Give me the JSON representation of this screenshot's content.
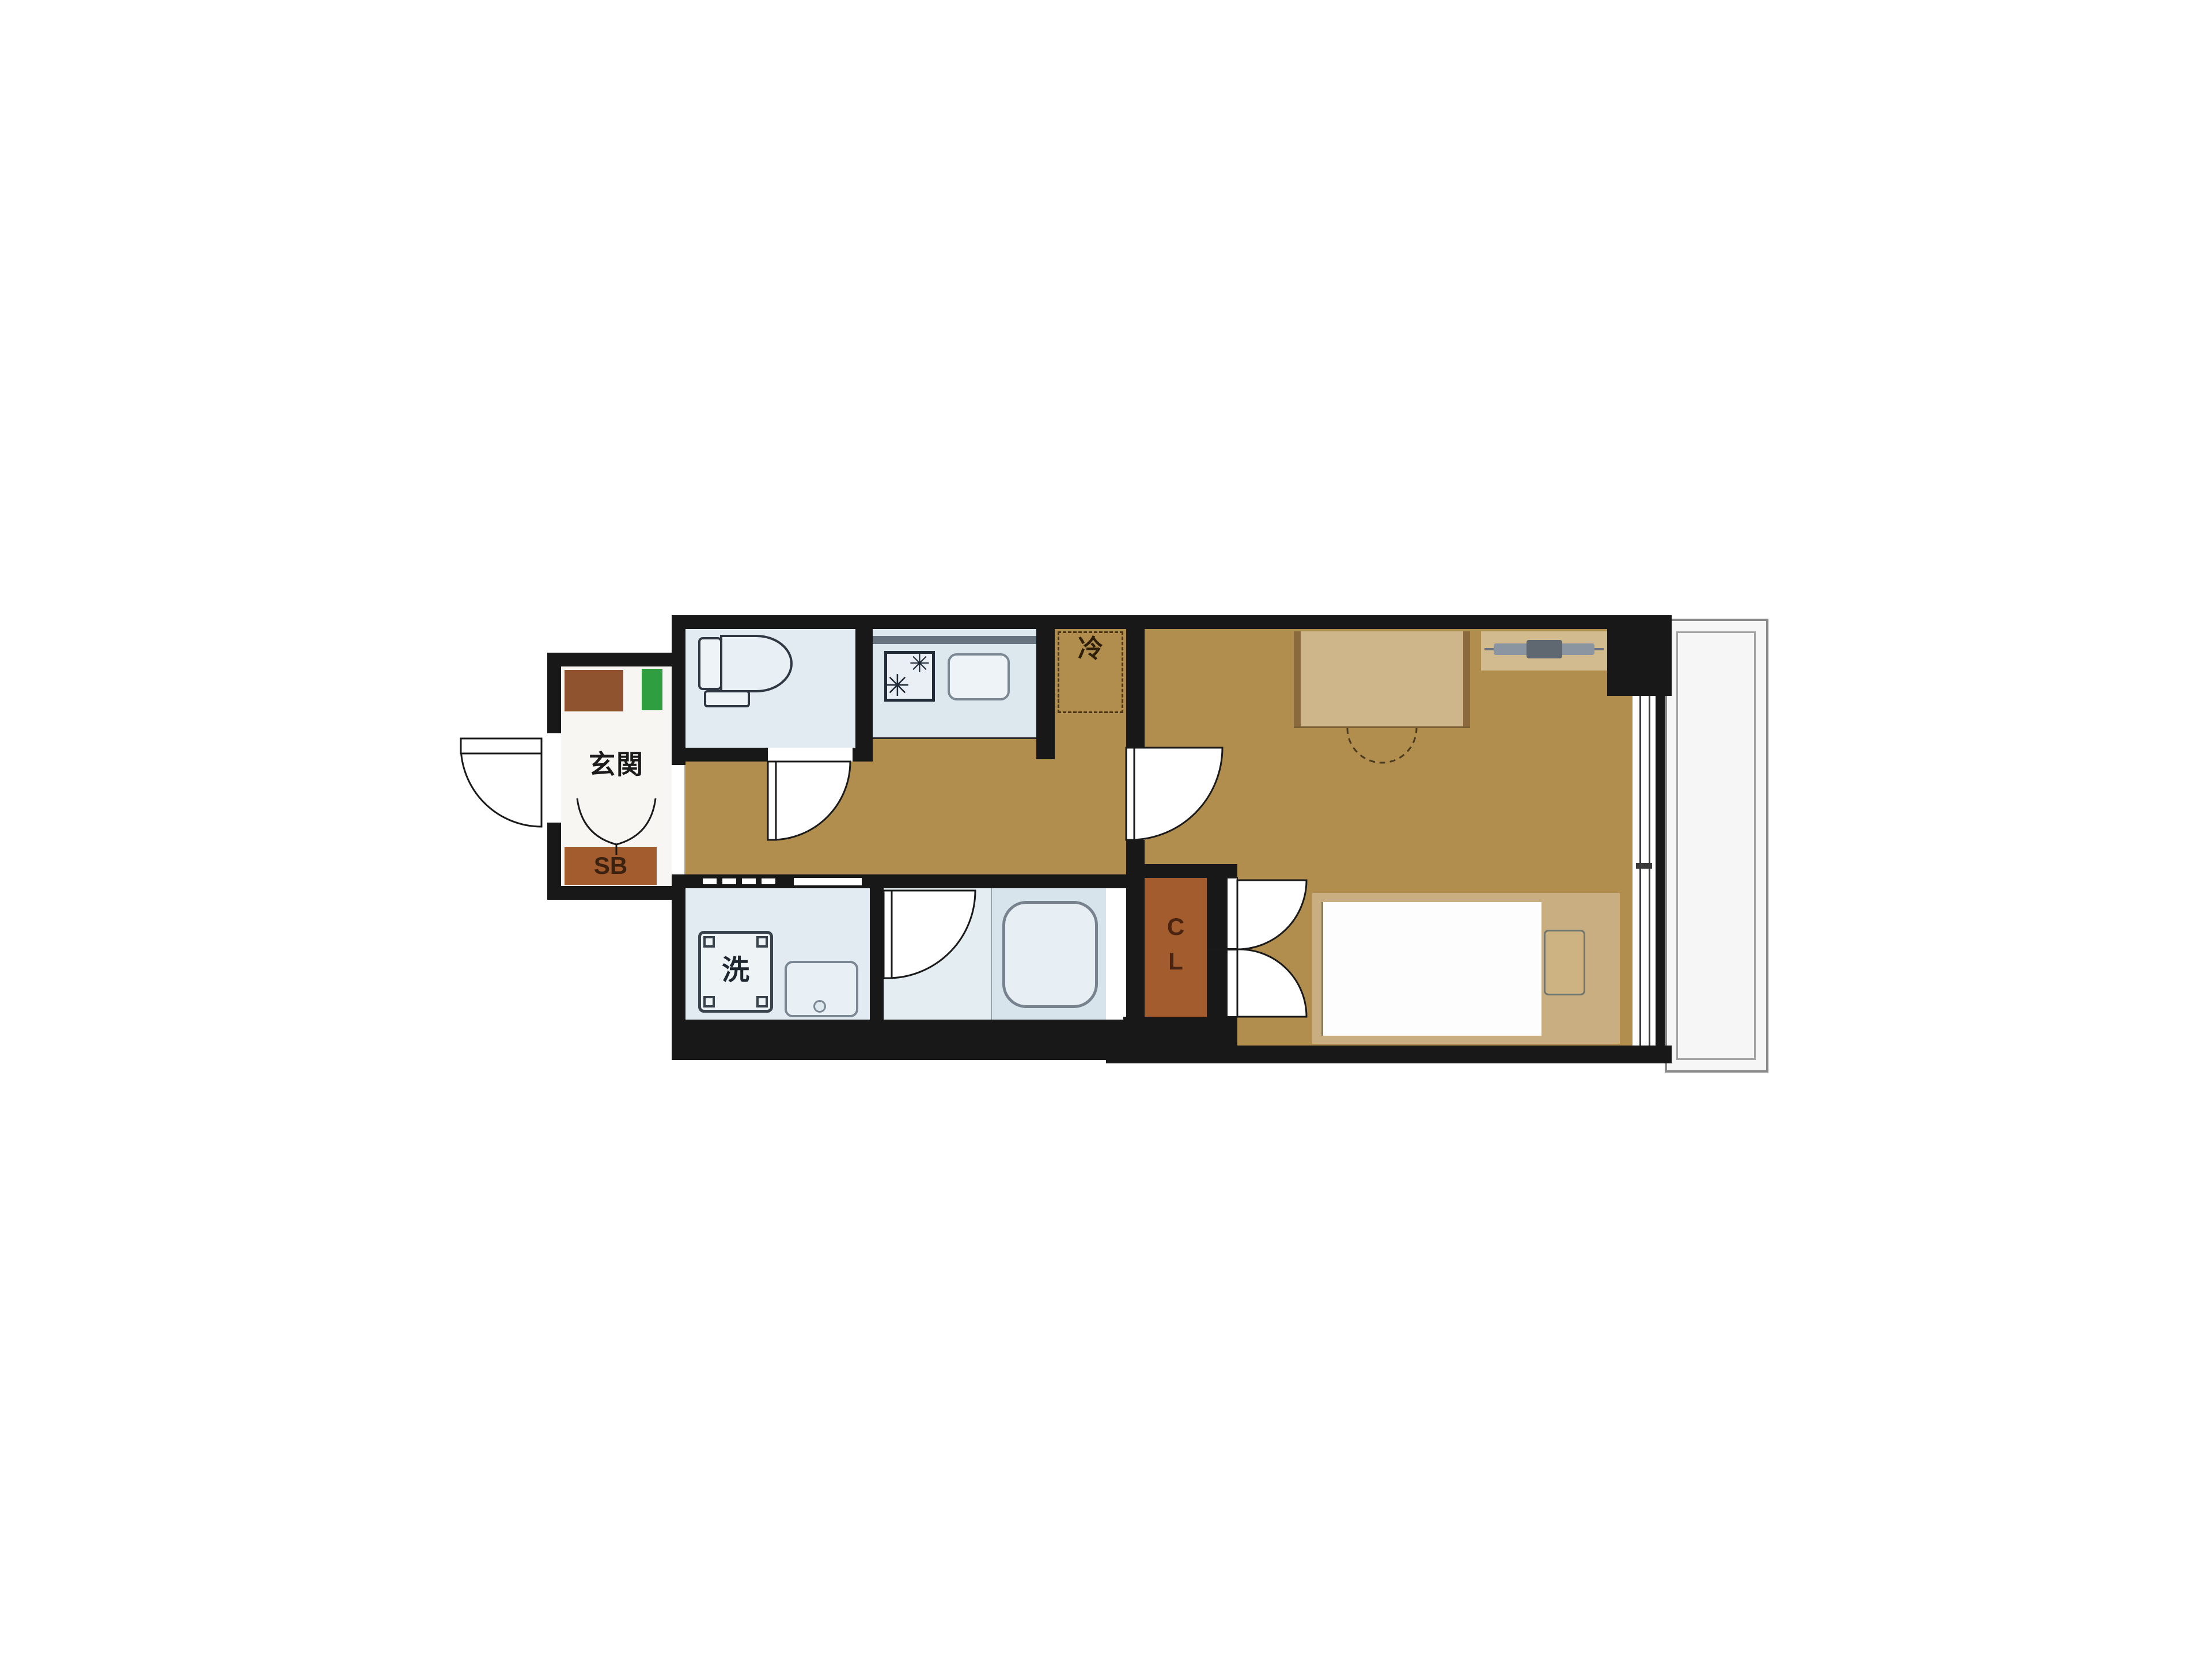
{
  "floorplan": {
    "type": "japanese-apartment-1K-floor-plan",
    "labels": {
      "entrance": "玄関",
      "shoe_box": "SB",
      "washing_machine": "洗",
      "refrigerator": "冷",
      "closet_line1": "C",
      "closet_line2": "L"
    },
    "icons": {
      "burner_large": "✳",
      "burner_small": "✳"
    },
    "colors": {
      "wall": "#181818",
      "flooring_tan": "#b28e4e",
      "wet_room_blue": "#e2ebf1",
      "kitchen_blue": "#dce8ee",
      "cabinet_brown": "#a25c2e",
      "meter_box_brown": "#8f5330",
      "pipe_space_green": "#2f9e41",
      "furniture_tan": "#cfb68a",
      "bed_frame_tan": "#c8ae80",
      "balcony_border_grey": "#8a8a8a",
      "fixture_outline": "#2e3742"
    }
  }
}
